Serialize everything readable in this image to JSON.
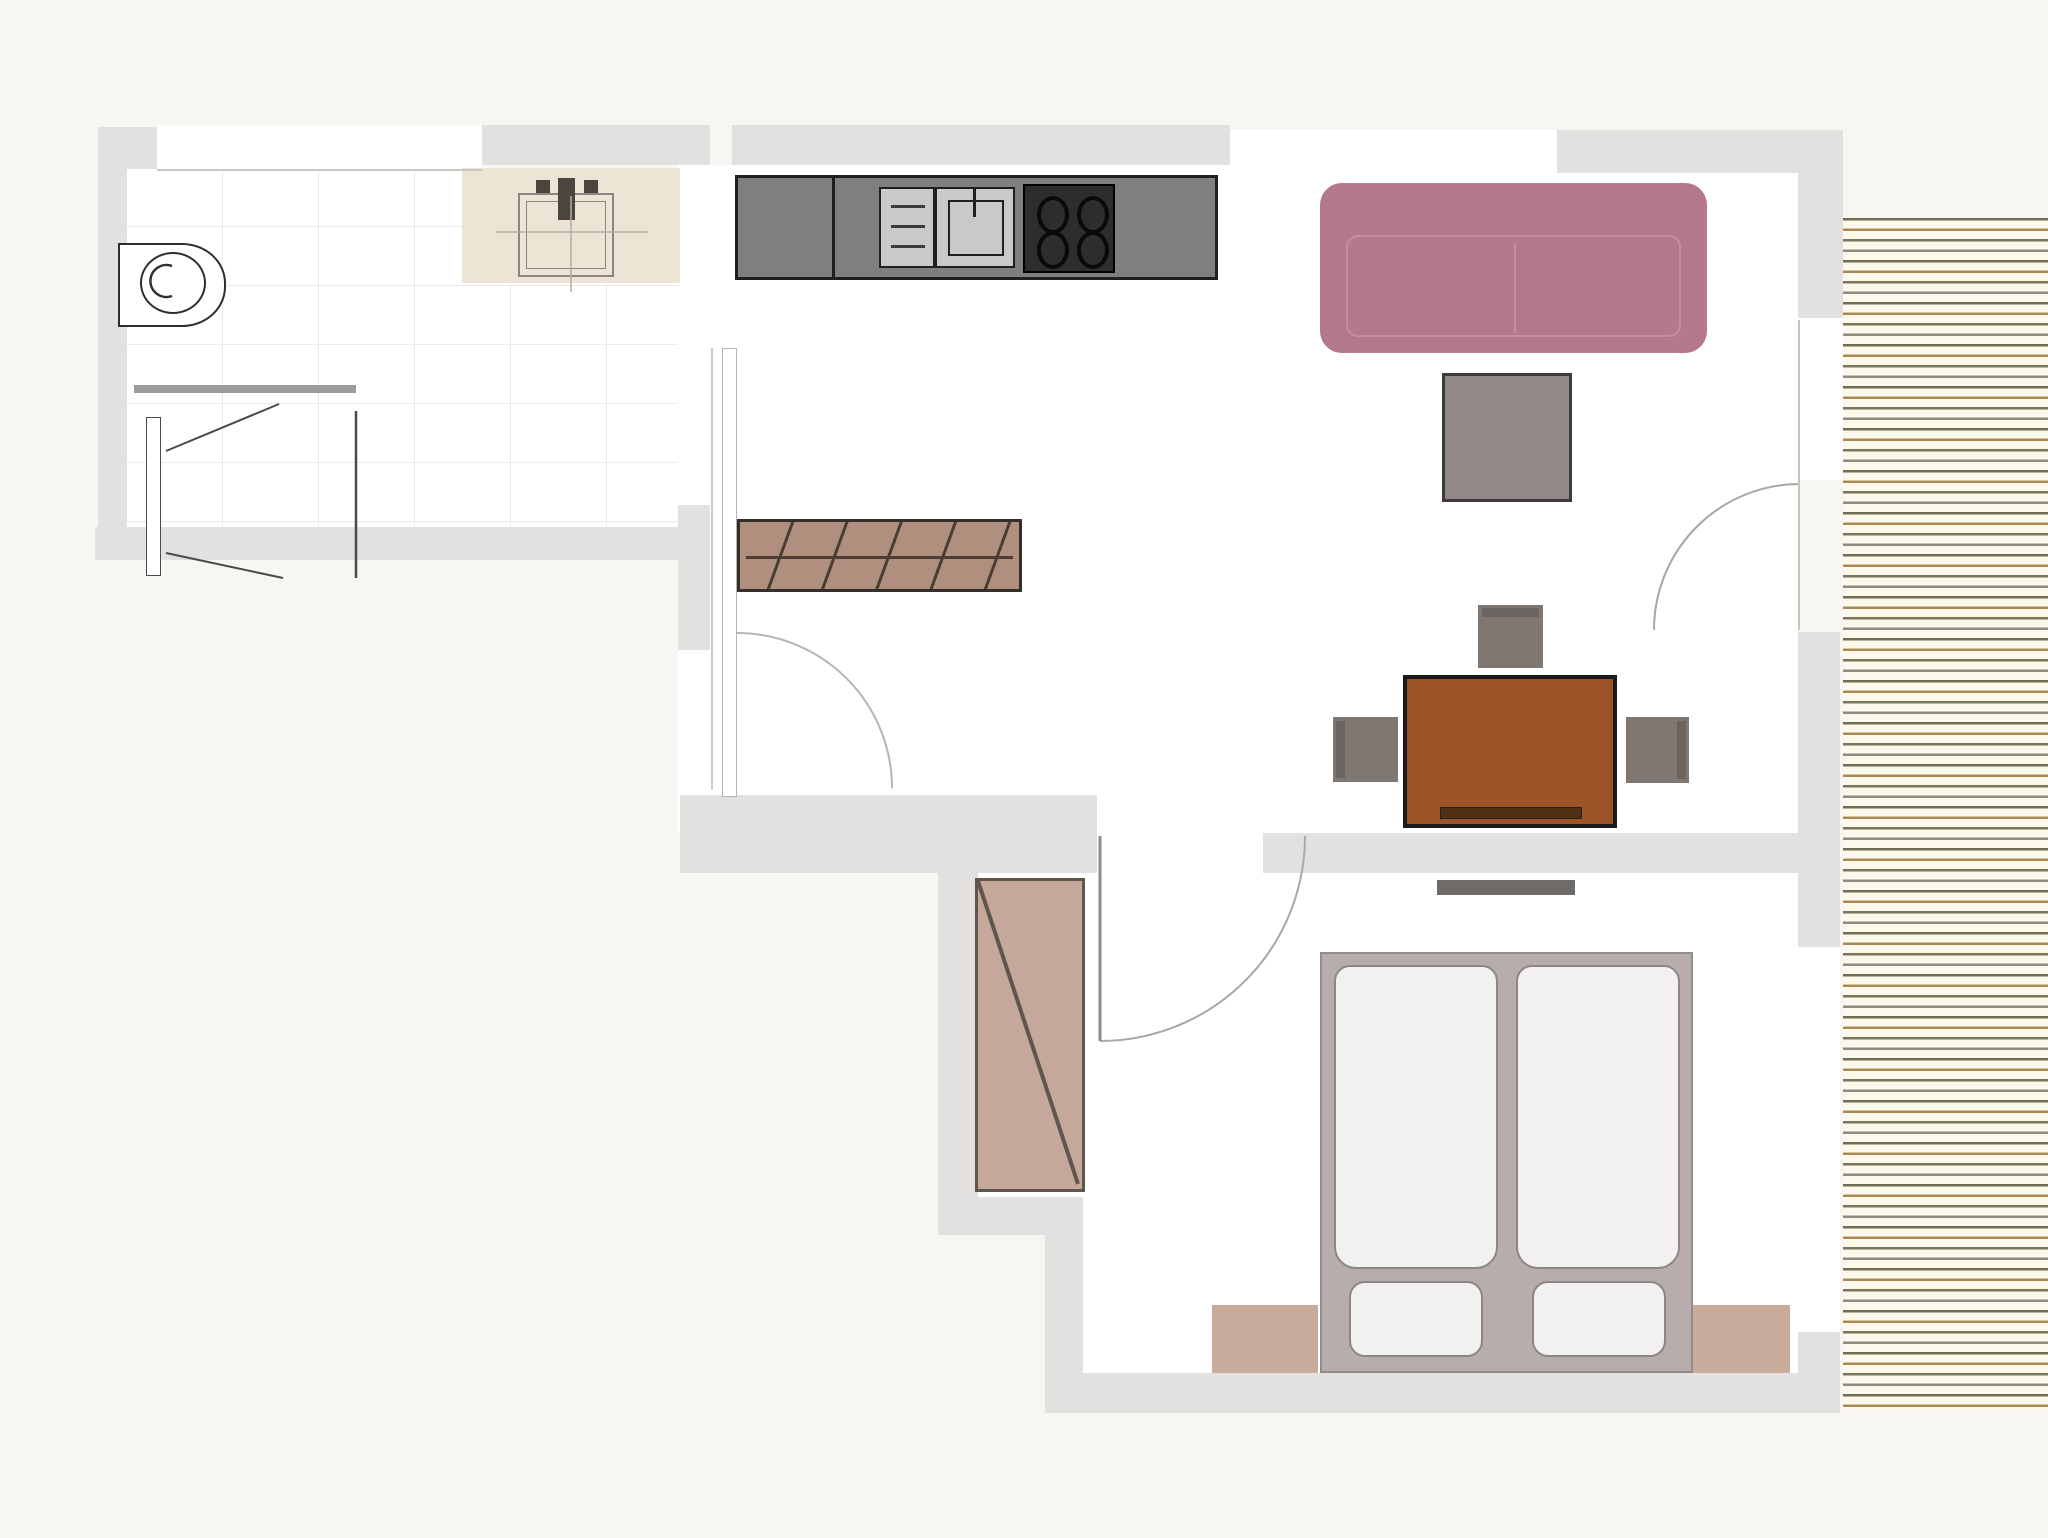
{
  "plan": {
    "title": "Apartment floor plan",
    "type": "floor-plan-diagram",
    "rooms": [
      {
        "name": "bathroom",
        "furniture": [
          "toilet",
          "vanity-sink",
          "shower"
        ]
      },
      {
        "name": "kitchen-hall",
        "furniture": [
          "kitchen-counter",
          "dishwasher",
          "kitchen-sink",
          "cooktop",
          "coat-rack-sideboard",
          "entry-door"
        ]
      },
      {
        "name": "living-room",
        "furniture": [
          "sofa",
          "coffee-table",
          "dining-table",
          "chair",
          "chair",
          "chair",
          "balcony-door"
        ]
      },
      {
        "name": "bedroom",
        "furniture": [
          "wardrobe",
          "double-bed",
          "mattress",
          "mattress",
          "pillow",
          "pillow",
          "nightstand",
          "nightstand",
          "radiator",
          "bedroom-door"
        ]
      },
      {
        "name": "balcony",
        "furniture": [
          "wood-decking"
        ]
      }
    ],
    "labels": {
      "bathroom": "Bathroom",
      "toilet": "Toilet",
      "vanity": "Vanity with sink",
      "shower": "Shower",
      "shower_screen": "Shower glass screen",
      "kitchen": "Kitchen",
      "counter": "Kitchen counter",
      "dishwasher": "Dishwasher / drawers",
      "kitchen_sink": "Kitchen sink",
      "cooktop": "Cooktop with 4 burners",
      "sideboard": "Coat rack / sideboard",
      "entry_door": "Entry door",
      "living_room": "Living room",
      "sofa": "Sofa",
      "coffee_table": "Coffee table",
      "dining_table": "Dining table",
      "bench": "Bench",
      "chair": "Chair",
      "radiator": "Radiator",
      "bedroom": "Bedroom",
      "bedroom_door": "Bedroom door",
      "wardrobe": "Wardrobe",
      "bed": "Double bed",
      "mattress": "Mattress",
      "pillow": "Pillow",
      "nightstand": "Nightstand",
      "balcony": "Balcony decking",
      "balcony_door": "Balcony door",
      "window": "Window"
    },
    "colors": {
      "bg": "#f7f6f3",
      "floor": "#ffffff",
      "wall": "#e2e1e0",
      "tile-line": "#ecebe9",
      "sofa": "#b5798d",
      "sofa-line": "#c28fa0",
      "coffee-table": "#918887",
      "dining-table": "#9b5427",
      "bench": "#4f3015",
      "chair": "#7e7772",
      "chair-back": "#6a6460",
      "radiator": "#6f6b68",
      "wardrobe": "#c6a89b",
      "wardrobe-line": "#5f564e",
      "sideboard": "#b18f7e",
      "sideboard-line": "#4a3d33",
      "bed-frame": "#b7adad",
      "mattress": "#f2f1ef",
      "mattress-line": "#8d8686",
      "nightstand": "#c9ab9b",
      "counter": "#7f7f7f",
      "counter-line": "#1f1f1f",
      "appliance": "#c9c9c9",
      "cooktop": "#2d2d2d",
      "vanity": "#ece4d4",
      "balcony-bg": "#fcf9ec",
      "deck-a": "#6f6f55",
      "deck-b": "#a98a55",
      "deck-c": "#8c8c82",
      "deck-d": "#77775e"
    }
  }
}
